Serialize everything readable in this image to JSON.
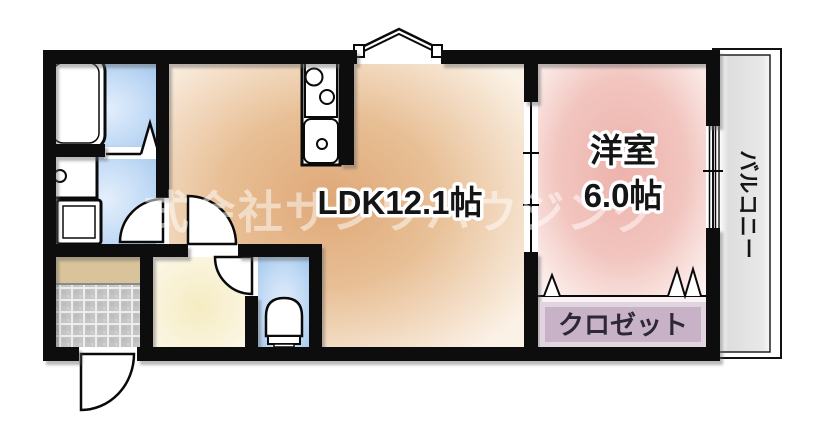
{
  "rooms": {
    "ldk": {
      "label": "LDK12.1帖"
    },
    "western": {
      "name": "洋室",
      "size": "6.0帖"
    },
    "closet": {
      "label": "クロゼット"
    },
    "balcony": {
      "label": "バルコニー"
    }
  },
  "watermark": {
    "text": "式会社サンワハウジング"
  },
  "fixtures": [
    "bathtub",
    "washbasin",
    "washing-machine",
    "toilet",
    "kitchen-counter",
    "stove-burners",
    "kitchen-sink",
    "hinged-door",
    "folding-door",
    "sliding-door",
    "bay-window",
    "closet-accordion-door",
    "entry-door",
    "balcony-window"
  ],
  "colors": {
    "wall": "#0a0a0a",
    "ldk_center": "#dfa878",
    "ldk_mid": "#e8bf95",
    "ldk_edge": "#fbf2e7",
    "western_center": "#edb2ab",
    "western_mid": "#f2c5bf",
    "western_edge": "#fdf3f1",
    "wet_center": "#e4effc",
    "wet_mid": "#c3dbf5",
    "wet_edge": "#a3c7ed",
    "hall_center": "#f5ecc2",
    "hall_edge": "#fcf8ea",
    "step": "#d9c39a",
    "tile": "#c4c4c4",
    "tile_grout": "#ededed",
    "closet_floor": "#f8f2f3",
    "closet_box": "#c7b2c8",
    "closet_box_edge": "#e0d4e0",
    "balcony_floor": "#e8e8e8",
    "watermark_color": "#ffffff"
  }
}
